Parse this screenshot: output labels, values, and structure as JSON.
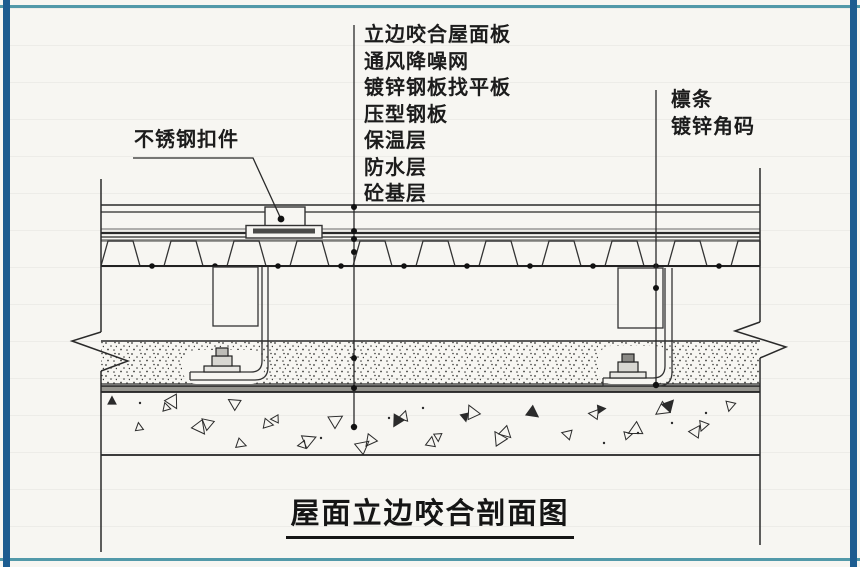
{
  "diagram": {
    "title": "屋面立边咬合剖面图",
    "callouts": {
      "top": [
        "立边咬合屋面板",
        "通风降噪网",
        "镀锌钢板找平板",
        "压型钢板",
        "保温层",
        "防水层",
        "砼基层"
      ],
      "left": "不锈钢扣件",
      "right": [
        "檩条",
        "镀锌角码"
      ]
    },
    "colors": {
      "frame_blue": "#1d5c90",
      "frame_teal": "#5299a9",
      "ink": "#262626",
      "paper": "#f7f6f2"
    }
  }
}
